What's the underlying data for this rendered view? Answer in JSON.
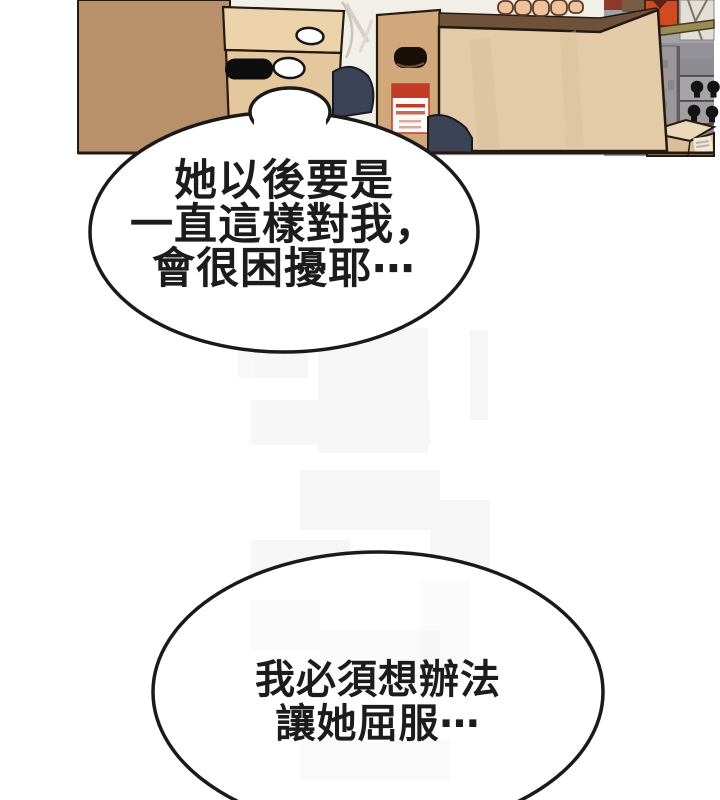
{
  "panel": {
    "description": "webtoon panel: storage room, person in white shirt lifting a large cardboard box among stacked boxes and a shelf of light-bulb cartons",
    "speech_bubbles": [
      {
        "lines": [
          "她以後要是",
          "一直這樣對我，",
          "會很困擾耶⋯"
        ]
      },
      {
        "lines": [
          "我必須想辦法",
          "讓她屈服⋯"
        ]
      }
    ],
    "palette": {
      "bubble_fill": "#ffffff",
      "bubble_outline": "#1a1a1a",
      "text_color": "#1c1c1c",
      "backdrop_shirt": "#f2efe9",
      "left_box": "#b8906a",
      "middle_box_lid": "#ecd2a9",
      "middle_box_body": "#e4c79d",
      "label_box": "#d0a87c",
      "large_box": "#e3cba8",
      "large_box_rim": "#6e523a",
      "box_outline": "#241a12",
      "pants_navy": "#3d4356",
      "shelf_gray": "#a3a2a6",
      "shelf_gray_dark": "#939298",
      "bulb_panel": "#8d8c91",
      "red_box": "#d14a20",
      "wood_board": "#9b8a52",
      "skin": "#efc29c",
      "label_red": "#c23b27",
      "small_box_top": "#ead8b8",
      "small_box_front": "#d8bf98"
    }
  }
}
